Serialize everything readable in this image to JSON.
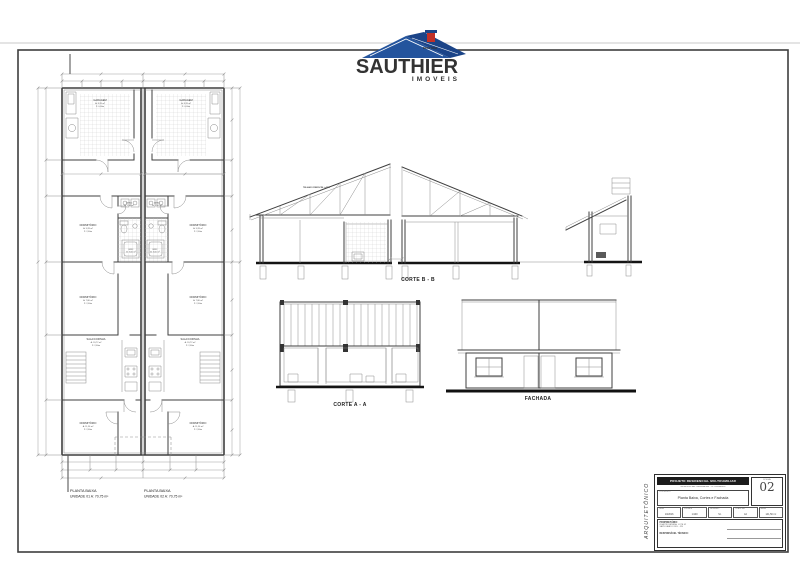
{
  "logo": {
    "brand": "SAUTHIER",
    "sub": "IMOVEIS",
    "tagline": "IMOBILIARIA",
    "blue": "#1c4796",
    "red": "#cf2b24"
  },
  "plan": {
    "unit1": {
      "line1": "PLANTA BAIXA",
      "line2": "UNIDADE 01   A: 70,75 m²"
    },
    "unit2": {
      "line1": "PLANTA BAIXA",
      "line2": "UNIDADE 02   A: 70,75 m²"
    },
    "rooms": {
      "garagem": {
        "name": "GARAGEM",
        "area": "A: 8,28 m²",
        "pd": "P: 0,00m"
      },
      "area_servico": {
        "name": "ÁREA",
        "area": "A: 1,56 m²"
      },
      "dorm1": {
        "name": "DORMITÓRIO",
        "area": "A: 9,28 m²",
        "pd": "P: 2,60m"
      },
      "bwc": {
        "name": "BWC",
        "area": "A: 3,60 m²"
      },
      "dorm2": {
        "name": "DORMITÓRIO",
        "area": "A: 7,80 m²",
        "pd": "P: 2,60m"
      },
      "sala": {
        "name": "SALA/COZINHA",
        "area": "A: 20,72 m²",
        "pd": "P: 2,60m"
      },
      "dorm3": {
        "name": "DORMITÓRIO",
        "area": "A: 11,56 m²",
        "pd": "P: 2,60m"
      }
    }
  },
  "sections": {
    "corte_bb": "CORTE B - B",
    "corte_aa": "CORTE A - A",
    "fachada": "FACHADA",
    "roof_note": "TELHADO FIBROCIM. i=27%"
  },
  "titleblock": {
    "discipline": "ARQUITETÔNICO",
    "header": "PROJETO RESIDENCIAL MULTIFAMILIAR",
    "subheader": "RESIDÊNCIAS GEMINADAS - 02 UNIDADES",
    "content_label": "CONTEÚDO",
    "content": "Planta Baixa, Cortes e Fachada",
    "sheet_label": "FOLHA",
    "sheet_number": "02",
    "fields": [
      {
        "label": "DATA",
        "value": "10/2016"
      },
      {
        "label": "ESCALA",
        "value": "1/100"
      },
      {
        "label": "DESENHO",
        "value": "S.I."
      },
      {
        "label": "PRANCHA",
        "value": "A4"
      },
      {
        "label": "ÁREA",
        "value": "141,50 m²"
      }
    ],
    "owner_label": "PROPRIETÁRIO:",
    "owner_lines": [
      "RUA PROJETADA, LOTE 02",
      "SAPUCAIA DO SUL - RS"
    ],
    "resp_label": "RESPONSÁVEL TÉCNICO:"
  }
}
